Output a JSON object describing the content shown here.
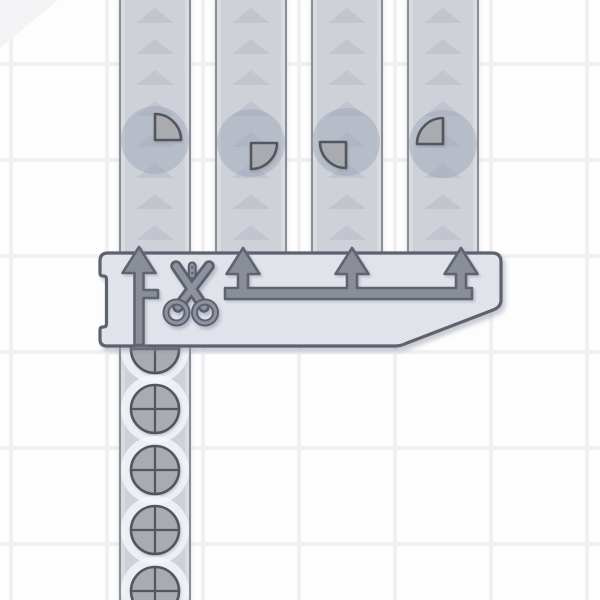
{
  "scene": {
    "app": "factory-game-viewport",
    "machine": {
      "type": "quad-cutter",
      "icon": "scissors",
      "inputs": 1,
      "outputs": 4
    }
  },
  "grid": {
    "pitch": 96,
    "line_x": 9,
    "line_y": 62,
    "line_width": 4
  },
  "layout": {
    "belt_bottom": 255
  },
  "belt_arrows": {
    "count": 8,
    "first_y": 8,
    "pitch": 31,
    "width": 38,
    "height": 15
  },
  "output_belts": [
    {
      "id": "conveyor-belt-up-1",
      "x": 119,
      "width": 72,
      "item": {
        "shape": "quarter-circle",
        "quadrant": "top-right",
        "cx": 155,
        "cy": 140
      }
    },
    {
      "id": "conveyor-belt-up-2",
      "x": 215,
      "width": 72,
      "item": {
        "shape": "quarter-circle",
        "quadrant": "bottom-right",
        "cx": 251,
        "cy": 143
      }
    },
    {
      "id": "conveyor-belt-up-3",
      "x": 311,
      "width": 72,
      "item": {
        "shape": "quarter-circle",
        "quadrant": "bottom-left",
        "cx": 346,
        "cy": 142
      }
    },
    {
      "id": "conveyor-belt-up-4",
      "x": 407,
      "width": 72,
      "item": {
        "shape": "quarter-circle",
        "quadrant": "top-left",
        "cx": 443,
        "cy": 144
      }
    }
  ],
  "input_belt": {
    "id": "conveyor-belt-input",
    "x": 119,
    "width": 72,
    "y": 340,
    "items": {
      "shape": "circle-quartered",
      "cx": 155,
      "cy_list": [
        349,
        409,
        470,
        530,
        591
      ]
    }
  },
  "machine_geometry": {
    "left": 100,
    "top": 253,
    "right": 501,
    "bottom": 346,
    "chamfer_top_y": 307,
    "chamfer_bottom_x": 404,
    "notch_top": 276,
    "notch_bottom": 327,
    "notch_depth": 6.5
  },
  "pipes": {
    "out1": {
      "cx": 139,
      "tip_y": 247,
      "head_base_y": 273,
      "head_half": 16.5,
      "shaft_half": 4.5,
      "shaft_bottom": 345,
      "stub": {
        "y1": 290,
        "y2": 298,
        "x2": 158
      }
    },
    "manifold": {
      "centers": [
        243,
        352,
        461
      ],
      "tip_y": 248,
      "head_base_y": 274,
      "head_half": 16.5,
      "riser_half": 5,
      "bar_y1": 288,
      "bar_y2": 299,
      "bar_x1": 225,
      "bar_x2": 472
    }
  },
  "colors": {
    "bg": "#fdfdfe",
    "grid_line": "#f0f0f4",
    "corner_accent": "#f3f3f6",
    "belt": "#ced1d8",
    "belt_edge": "#8b8e98",
    "belt_edge_inner": "#d9dbe0",
    "belt_arrow": "#c2c5ce",
    "item_halo_dark": "rgba(150,158,180,0.40)",
    "item_halo_light": "rgba(245,247,251,0.78)",
    "shape_fill": "#a9abb0",
    "shape_outline": "#53565c",
    "machine_fill": "#e0e3ea",
    "machine_outline": "#5e6270",
    "pipe_fill": "#8a8e99",
    "pipe_outline": "#60646f",
    "scissors_fill": "#8d929e",
    "scissors_outline": "#5c606d"
  }
}
